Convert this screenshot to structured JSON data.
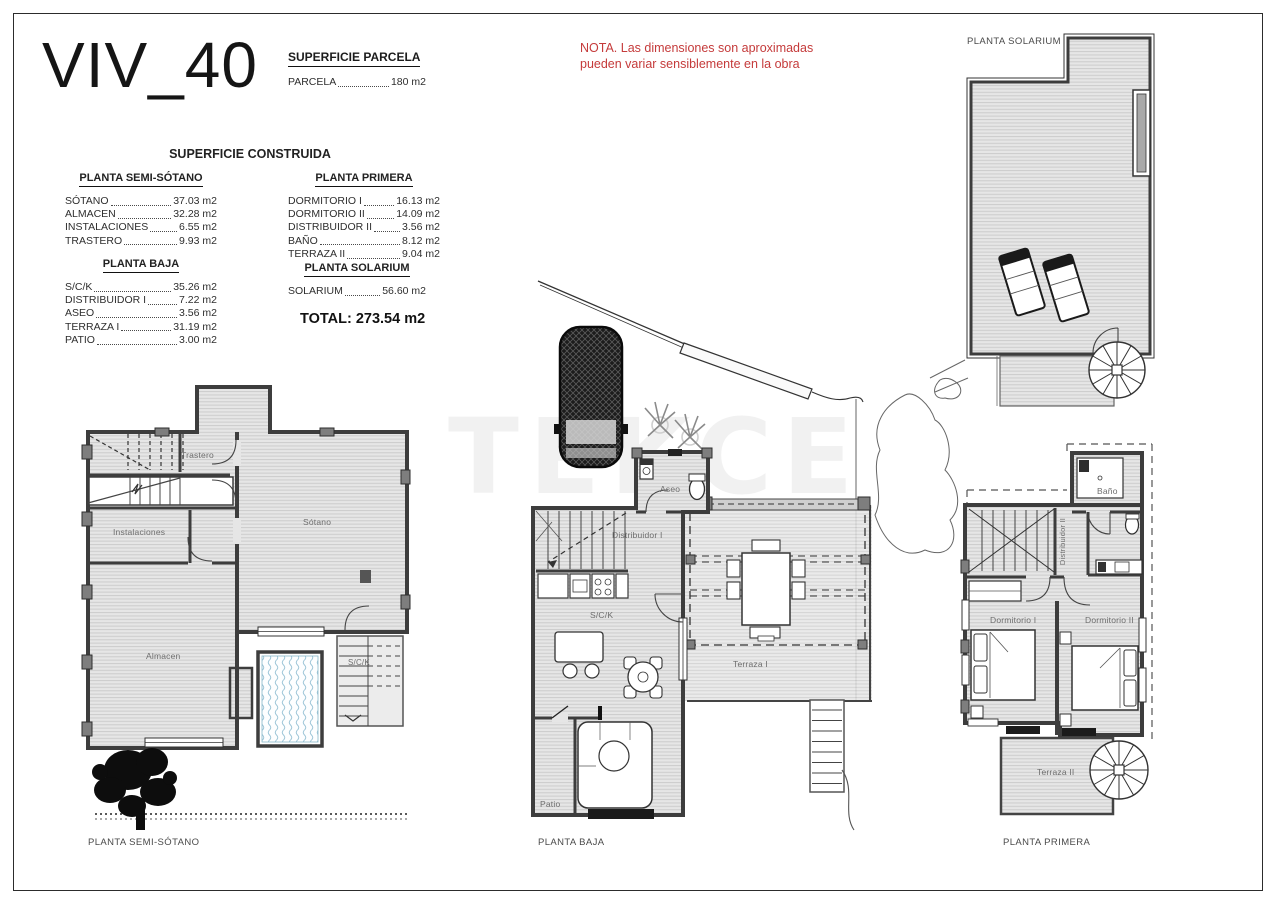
{
  "page": {
    "title": "VIV_40",
    "note_line1": "NOTA. Las dimensiones son aproximadas",
    "note_line2": "pueden variar sensiblemente en la obra",
    "watermark": "TEKCE",
    "accent_red": "#c53b3b"
  },
  "superficie_parcela": {
    "title": "SUPERFICIE PARCELA",
    "items": [
      {
        "label": "PARCELA",
        "value": "180 m2"
      }
    ]
  },
  "superficie_construida": {
    "title": "SUPERFICIE CONSTRUIDA",
    "total": "TOTAL: 273.54 m2",
    "groups": [
      {
        "title": "PLANTA SEMI-SÓTANO",
        "items": [
          {
            "label": "SÓTANO",
            "value": "37.03 m2"
          },
          {
            "label": "ALMACEN",
            "value": "32.28 m2"
          },
          {
            "label": "INSTALACIONES",
            "value": "6.55 m2"
          },
          {
            "label": "TRASTERO",
            "value": "9.93 m2"
          }
        ]
      },
      {
        "title": "PLANTA BAJA",
        "items": [
          {
            "label": "S/C/K",
            "value": "35.26 m2"
          },
          {
            "label": "DISTRIBUIDOR I",
            "value": "7.22 m2"
          },
          {
            "label": "ASEO",
            "value": "3.56 m2"
          },
          {
            "label": "TERRAZA I",
            "value": "31.19 m2"
          },
          {
            "label": "PATIO",
            "value": "3.00 m2"
          }
        ]
      },
      {
        "title": "PLANTA PRIMERA",
        "items": [
          {
            "label": "DORMITORIO I",
            "value": "16.13 m2"
          },
          {
            "label": "DORMITORIO II",
            "value": "14.09 m2"
          },
          {
            "label": "DISTRIBUIDOR II",
            "value": "3.56 m2"
          },
          {
            "label": "BAÑO",
            "value": "8.12 m2"
          },
          {
            "label": "TERRAZA II",
            "value": "9.04 m2"
          }
        ]
      },
      {
        "title": "PLANTA SOLARIUM",
        "items": [
          {
            "label": "SOLARIUM",
            "value": "56.60 m2"
          }
        ]
      }
    ]
  },
  "plans": {
    "semisotano": {
      "caption": "PLANTA SEMI-SÓTANO",
      "rooms": {
        "trastero": "Trastero",
        "sotano": "Sótano",
        "instalaciones": "Instalaciones",
        "almacen": "Almacen",
        "sck": "S/C/K"
      }
    },
    "baja": {
      "caption": "PLANTA BAJA",
      "rooms": {
        "aseo": "Aseo",
        "distribuidor": "Distribuidor I",
        "sck": "S/C/K",
        "terraza": "Terraza I",
        "patio": "Patio"
      }
    },
    "primera": {
      "caption": "PLANTA PRIMERA",
      "rooms": {
        "bano": "Baño",
        "distribuidor": "Distribuidor II",
        "dorm1": "Dormitorio I",
        "dorm2": "Dormitorio II",
        "terraza": "Terraza II"
      }
    },
    "solarium": {
      "caption": "PLANTA SOLARIUM"
    }
  }
}
